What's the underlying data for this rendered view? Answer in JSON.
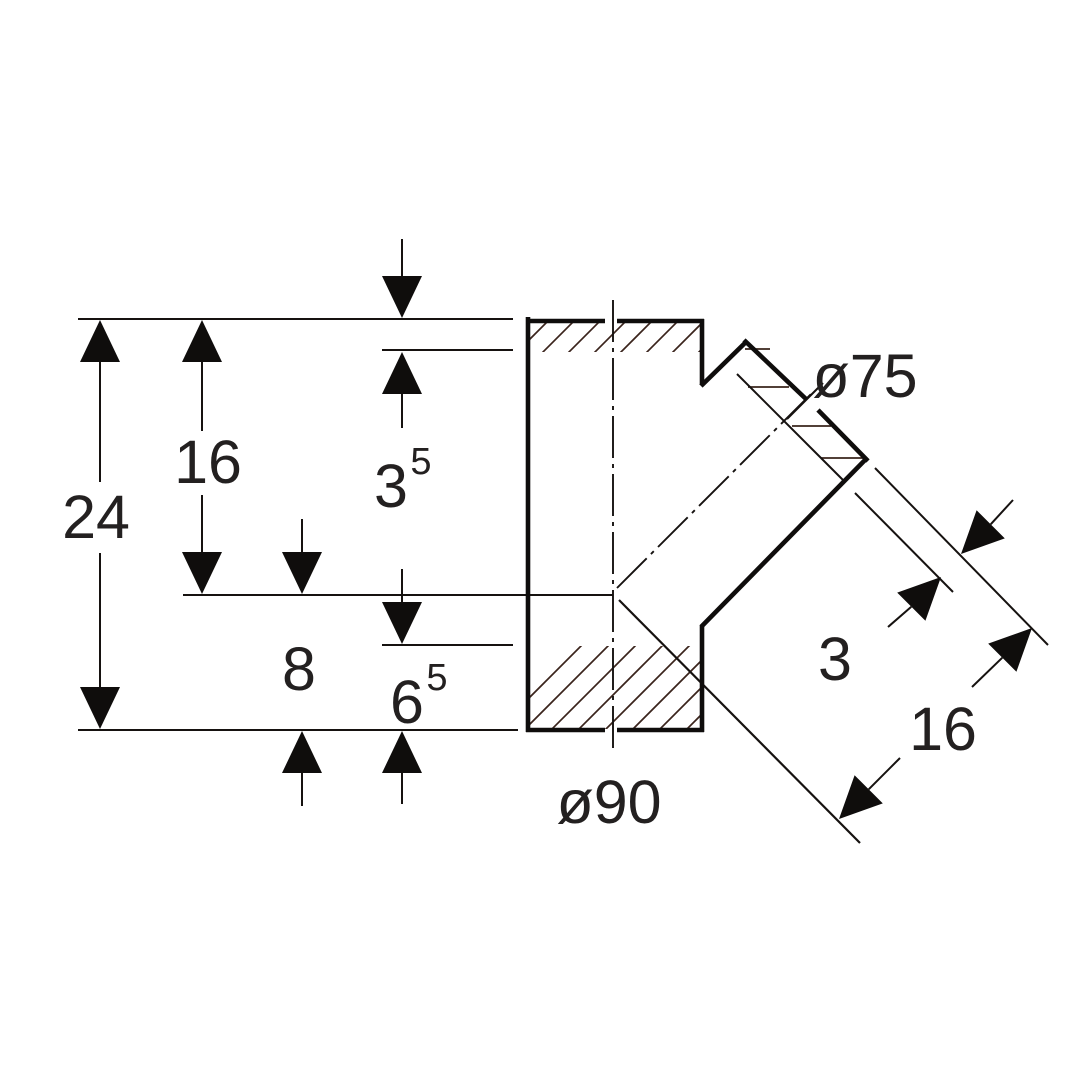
{
  "drawing": {
    "type": "technical-dimension-drawing",
    "subject": "45-degree branch pipe fitting cross-section",
    "dimensions": {
      "total_height": "24",
      "upper_height": "16",
      "top_wall": {
        "value": "3",
        "sup": "5"
      },
      "lower_height": "8",
      "bottom_wall": {
        "value": "6",
        "sup": "5"
      },
      "branch_wall": "3",
      "branch_length": "16",
      "main_diameter": "ø90",
      "branch_diameter": "ø75"
    },
    "colors": {
      "line": "#161210",
      "outline": "#0f0d0c",
      "hatch": "#3a241c",
      "text": "#232020",
      "background": "#ffffff"
    }
  }
}
